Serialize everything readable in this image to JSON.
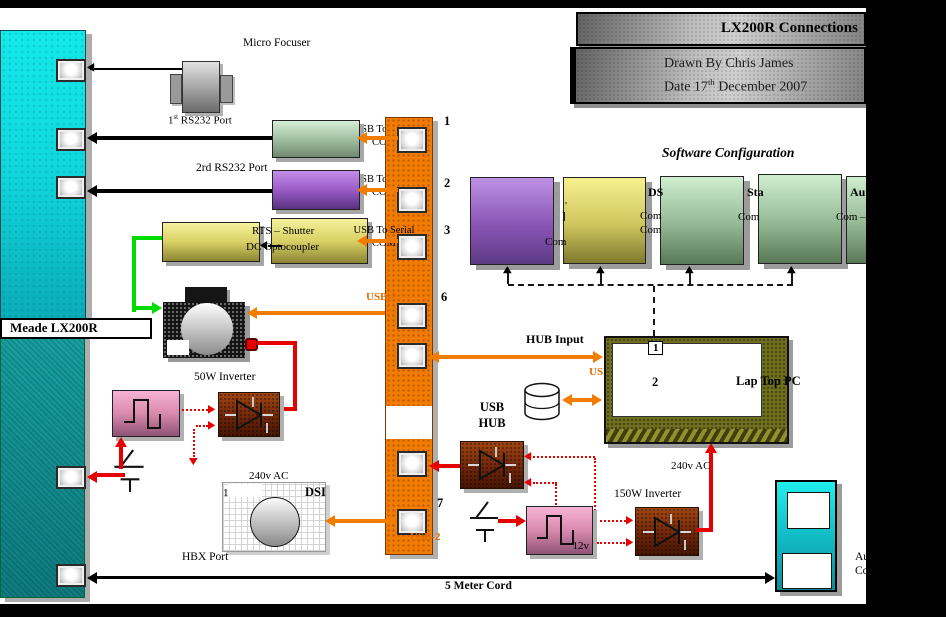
{
  "header": {
    "title": "LX200R Connections",
    "drawn_by": "Drawn By Chris James",
    "date_pre": "Date 17",
    "date_sup": "th",
    "date_post": " December 2007"
  },
  "telescope": {
    "label": "Meade LX200R",
    "port1_pre": "1",
    "port1_sup": "st",
    "port1_post": " RS232 Port",
    "port2_label": "2rd RS232 Port",
    "hbx_label": "HBX Port",
    "cord_label": "5 Meter Cord"
  },
  "focuser": {
    "label": "Micro Focuser"
  },
  "converters": {
    "usb_to_serial": "USB To Serial",
    "com": "COM",
    "rts_line": "RTS – Shutter",
    "dc_line": "DC Optocoupler"
  },
  "hub": {
    "port_numbers": [
      "1",
      "2",
      "3",
      "6",
      "7"
    ],
    "usb2": "USB-2",
    "hub_input": "HUB Input",
    "usb_word": "USB",
    "hub_word": "HUB"
  },
  "software": {
    "title": "Software Configuration",
    "frag_com": "Com",
    "frag_quote": "'",
    "frag_bracket": "]",
    "frag_ds": "DS",
    "frag_sta": "Sta",
    "frag_au": "Au",
    "frag_com_dash": "Com –"
  },
  "laptop": {
    "label": "Lap Top PC",
    "port1": "1",
    "port2": "2"
  },
  "power": {
    "inverter_50w": "50W Inverter",
    "inverter_150w": "150W Inverter",
    "ac_240v": "240v AC",
    "dc_12v": "12v"
  },
  "dsi": {
    "label": "DSI",
    "port": "1"
  },
  "handbox": {
    "frag1": "Au",
    "frag2": "Co"
  }
}
